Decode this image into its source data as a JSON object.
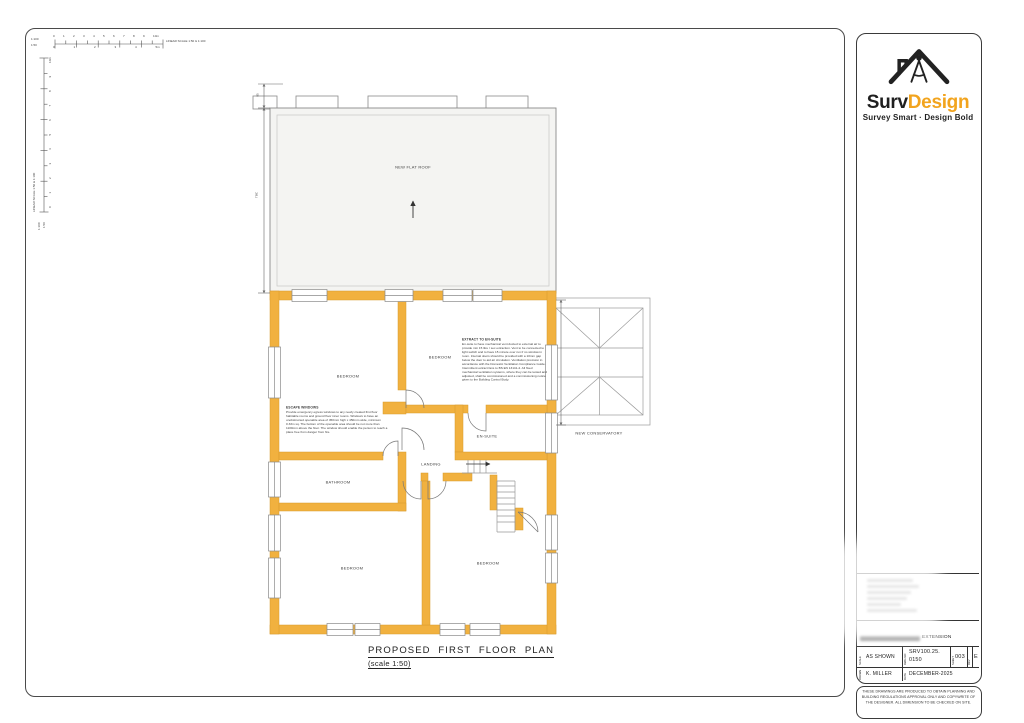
{
  "colors": {
    "wall_yellow": "#F1B13F",
    "brand_orange": "#F2A41E",
    "roof_fill": "#F4F4F2"
  },
  "scalebar": {
    "h1_label": "1:100",
    "h2_label": "1:50",
    "h_row1": "0 1 2 3 4 5 6 7 8 9 10m",
    "h_row2": "0 1 2 3 4 5m",
    "v_row": "0 1 2 3 4 5 6 7 8 9 10m",
    "right_label": "LINEAR SCALE 1:50 & 1:100",
    "vertical_label": "LINEAR SCALE 1:50 & 1:100"
  },
  "plan": {
    "title": "PROPOSED FIRST FLOOR PLAN",
    "subtitle": "(scale 1:50)",
    "roof_label": "NEW FLAT ROOF",
    "conservatory_label": "NEW CONSERVATORY",
    "dim_top": "85",
    "dim_side": "TBC",
    "rooms": {
      "bedroom_tl": "BEDROOM",
      "bedroom_tr": "BEDROOM",
      "bedroom_bl": "BEDROOM",
      "bedroom_br": "BEDROOM",
      "ensuite": "EN-SUITE",
      "bathroom": "BATHROOM",
      "landing": "LANDING"
    },
    "notes": {
      "escape": {
        "heading": "ESCAPE WINDOWS",
        "body": "Provide emergency egress windows to any newly created first floor habitable rooms and ground floor inner rooms. Windows to have an unobstructed openable area of 450mm high x 450mm wide, minimum 0.33m sq. The bottom of the openable area should be not more than 1100mm above the floor. The window should enable the person to reach a place free from danger from fire."
      },
      "extract": {
        "heading": "EXTRACT TO EN-SUITE",
        "body": "En-suite to have mechanical vent ducted to external air to provide min 15 litre / sec extraction. Vent to be connected to light switch and to have 15 minute over run if no window in room. Internal doors should be provided with a 10mm gap below the door to aid air circulation. Ventilation provision in accordance with the Domestic Ventilation Compliance Guide. Intermittent extract fans to BS EN 13141-4. All fixed mechanical ventilation systems, where they can be tested and adjusted, shall be commissioned and a commissioning notice given to the Building Control Body."
      }
    }
  },
  "titleblock": {
    "brand_black": "Surv",
    "brand_orange": "Design",
    "tagline": "Survey Smart · Design Bold",
    "project_title_visible": "EXTENSION",
    "scale_label": "SCALE",
    "scale_value": "AS SHOWN",
    "dwg_label": "DWG NO",
    "dwg_value_1": "SRV100.25.",
    "dwg_value_2": "0150",
    "sheet_label": "SHEET",
    "sheet_value": "003",
    "rev_label": "REV",
    "rev_value": "E",
    "drawn_label": "DRAWN",
    "drawn_value": "K. MILLER",
    "date_label": "DATE",
    "date_value": "DECEMBER-2025",
    "disclaimer": "THESE DRAWINGS ARE PRODUCED TO OBTAIN PLANNING AND BUILDING REGULATIONS APPROVAL ONLY AND COPYWRITE OF THE DESIGNER. ALL DIMENSION TO BE CHECKED ON SITE."
  }
}
